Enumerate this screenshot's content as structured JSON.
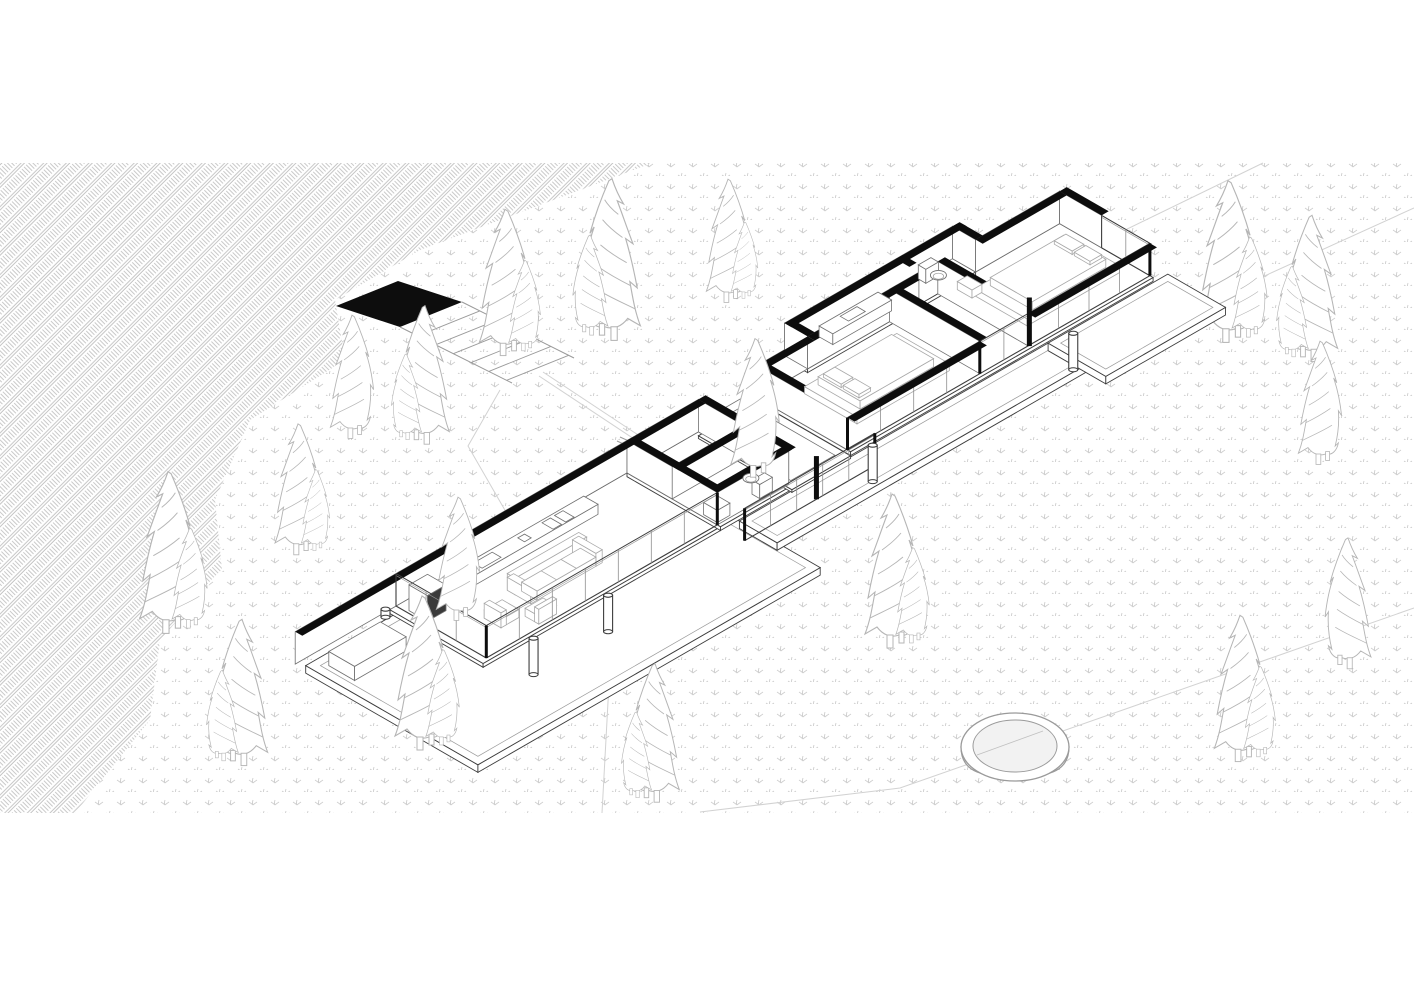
{
  "colors": {
    "paper": "#ffffff",
    "black_wall": "#0d0d0d",
    "line_dark": "#3d3d3d",
    "line_mid": "#6f6f6f",
    "line_light": "#9a9a9a",
    "glass_mullion": "#8f8f8f",
    "tree_stroke": "#b5b5b5",
    "hatch_stroke": "#b7b7b7",
    "dots_stroke": "#cdcdcd",
    "contour": "#d2d2d2",
    "water": "#f2f2f2",
    "furniture_light": "#a8a8a8",
    "dark_face": "#3a3a3a"
  },
  "iso": {
    "ox": 396,
    "oy": 606,
    "kx": 21,
    "ky": 12.1,
    "kz": 27,
    "wallH": 1.2,
    "bandTh": 0.34
  },
  "regions": {
    "hatch_slope": [
      [
        0,
        163
      ],
      [
        652,
        163
      ],
      [
        420,
        250
      ],
      [
        335,
        300
      ],
      [
        345,
        360
      ],
      [
        250,
        420
      ],
      [
        215,
        500
      ],
      [
        222,
        570
      ],
      [
        160,
        640
      ],
      [
        150,
        720
      ],
      [
        75,
        813
      ],
      [
        0,
        813
      ]
    ],
    "dotted_meadow": [
      [
        652,
        163
      ],
      [
        1414,
        163
      ],
      [
        1414,
        813
      ],
      [
        75,
        813
      ],
      [
        150,
        720
      ],
      [
        160,
        640
      ],
      [
        222,
        570
      ],
      [
        215,
        500
      ],
      [
        250,
        420
      ],
      [
        345,
        360
      ],
      [
        335,
        300
      ],
      [
        420,
        250
      ]
    ]
  },
  "contours": [
    [
      [
        940,
        320
      ],
      [
        1263,
        163
      ]
    ],
    [
      [
        1150,
        328
      ],
      [
        1414,
        208
      ]
    ],
    [
      [
        700,
        812
      ],
      [
        900,
        788
      ],
      [
        1414,
        608
      ]
    ]
  ],
  "trail": [
    [
      500,
      390
    ],
    [
      468,
      446
    ],
    [
      525,
      545
    ],
    [
      610,
      665
    ],
    [
      602,
      813
    ]
  ],
  "stairs": {
    "landing": [
      [
        336,
        306
      ],
      [
        398,
        281
      ],
      [
        462,
        302
      ],
      [
        400,
        327
      ]
    ],
    "railA": [
      [
        400,
        327
      ],
      [
        512,
        383
      ]
    ],
    "railB": [
      [
        462,
        302
      ],
      [
        574,
        358
      ]
    ],
    "steps": 6,
    "path": [
      [
        543,
        372
      ],
      [
        688,
        468
      ]
    ],
    "path2": [
      [
        539,
        376
      ],
      [
        684,
        472
      ]
    ]
  },
  "bridge": {
    "l1": [
      [
        620,
        437
      ],
      [
        688,
        468
      ]
    ],
    "l2": [
      [
        617,
        441
      ],
      [
        685,
        472
      ]
    ]
  },
  "trees_back": [
    {
      "x": 505,
      "y": 348,
      "s": 0.95,
      "f": 0,
      "d": 1
    },
    {
      "x": 612,
      "y": 332,
      "s": 1.05,
      "f": 1,
      "d": 1
    },
    {
      "x": 728,
      "y": 296,
      "s": 0.8,
      "f": 0,
      "d": 1
    },
    {
      "x": 352,
      "y": 432,
      "s": 0.8,
      "f": 0,
      "d": 0
    },
    {
      "x": 425,
      "y": 437,
      "s": 0.9,
      "f": 1,
      "d": 1
    },
    {
      "x": 298,
      "y": 548,
      "s": 0.85,
      "f": 0,
      "d": 1
    },
    {
      "x": 168,
      "y": 625,
      "s": 1.05,
      "f": 0,
      "d": 1
    },
    {
      "x": 242,
      "y": 758,
      "s": 0.95,
      "f": 1,
      "d": 1
    },
    {
      "x": 1228,
      "y": 334,
      "s": 1.05,
      "f": 0,
      "d": 1
    },
    {
      "x": 1312,
      "y": 354,
      "s": 0.95,
      "f": 1,
      "d": 1
    },
    {
      "x": 1320,
      "y": 458,
      "s": 0.8,
      "f": 0,
      "d": 0
    }
  ],
  "trees_front": [
    {
      "x": 755,
      "y": 470,
      "s": 0.9,
      "f": 0,
      "d": 0
    },
    {
      "x": 458,
      "y": 614,
      "s": 0.8,
      "f": 0,
      "d": 0
    },
    {
      "x": 422,
      "y": 742,
      "s": 1.0,
      "f": 0,
      "d": 1
    },
    {
      "x": 655,
      "y": 795,
      "s": 0.9,
      "f": 1,
      "d": 1
    },
    {
      "x": 892,
      "y": 640,
      "s": 1.0,
      "f": 0,
      "d": 1
    },
    {
      "x": 1240,
      "y": 754,
      "s": 0.95,
      "f": 0,
      "d": 1
    },
    {
      "x": 1348,
      "y": 662,
      "s": 0.85,
      "f": 1,
      "d": 0
    }
  ],
  "hot_tub": {
    "x": 1015,
    "y": 747,
    "rx": 54,
    "ry": 34,
    "irx": 42,
    "iry": 26,
    "depth": 30
  },
  "slabs": [
    {
      "n": "terrace-deck",
      "a1": -4.5,
      "b1": 0.2,
      "a2": 11.8,
      "b2": 8.4,
      "z": -0.1,
      "th": 0.28,
      "inset": 0.35
    },
    {
      "n": "walkway-deck",
      "a1": 11.8,
      "b1": 4.55,
      "a2": 26.5,
      "b2": 6.35,
      "z": -0.1,
      "th": 0.28,
      "inset": 0.3
    },
    {
      "n": "right-deck",
      "a1": 26.5,
      "b1": 4.55,
      "a2": 32.2,
      "b2": 7.3,
      "z": -0.1,
      "th": 0.28,
      "inset": 0.3
    },
    {
      "n": "living-floor",
      "a1": -0.3,
      "b1": 0,
      "a2": 11,
      "b2": 4.45,
      "z": 0,
      "th": 0.14,
      "inset": 0
    },
    {
      "n": "middle-floor",
      "a1": 11,
      "b1": 0,
      "a2": 14.4,
      "b2": 4.45,
      "z": 0,
      "th": 0.14,
      "inset": 0
    },
    {
      "n": "courtyard-floor",
      "a1": 14.4,
      "b1": 0,
      "a2": 17.2,
      "b2": 4.45,
      "z": -0.15,
      "th": 0.1,
      "inset": 0
    },
    {
      "n": "right-wing-floor",
      "a1": 17.2,
      "b1": 0,
      "a2": 31.6,
      "b2": 4.45,
      "z": 0,
      "th": 0.14,
      "inset": 0
    },
    {
      "n": "bath-strip-floor",
      "a1": 19.6,
      "b1": -1.15,
      "a2": 27.6,
      "b2": 0,
      "z": 0,
      "th": 0.14,
      "inset": 0
    }
  ],
  "court_paving": {
    "a1": 14.75,
    "b1": 0.4,
    "a2": 16.85,
    "b2": 4.05,
    "z": -0.15
  },
  "wall_faces": [
    {
      "n": "site-wall",
      "dir": "a",
      "a1": -4.8,
      "a2": 11,
      "b": 0,
      "h": 1.2
    },
    {
      "n": "court-parapet",
      "dir": "a",
      "a1": 14.4,
      "a2": 17.2,
      "b": 0,
      "h": 0.32
    },
    {
      "n": "mid-back-wall",
      "dir": "a",
      "a1": 11,
      "a2": 14.4,
      "b": 0,
      "h": 1.2
    },
    {
      "n": "mid-divider-left",
      "dir": "b",
      "b1": 0,
      "b2": 4.3,
      "a": 11,
      "h": 1.2
    },
    {
      "n": "mid-cross-wall",
      "dir": "a",
      "a1": 11,
      "a2": 14.4,
      "b": 2.15,
      "h": 1.2
    },
    {
      "n": "mid-divider-right",
      "dir": "b",
      "b1": 0,
      "b2": 4.3,
      "a": 14.4,
      "h": 1.2
    },
    {
      "n": "mid-front-wall",
      "dir": "a",
      "a1": 11,
      "a2": 14.4,
      "b": 4.3,
      "h": 1.2
    },
    {
      "n": "rw-back-1",
      "dir": "a",
      "a1": 17.05,
      "a2": 19.6,
      "b": 0,
      "h": 1.2
    },
    {
      "n": "rw-bath-jog-l",
      "dir": "b",
      "b1": -1.1,
      "b2": 0,
      "a": 19.6,
      "h": 1.2
    },
    {
      "n": "rw-bath-back",
      "dir": "a",
      "a1": 19.6,
      "a2": 27.6,
      "b": -1.1,
      "h": 1.2
    },
    {
      "n": "rw-bath-jog-r",
      "dir": "b",
      "b1": -1.1,
      "b2": 0,
      "a": 27.6,
      "h": 1.2
    },
    {
      "n": "rw-back-2",
      "dir": "a",
      "a1": 27.6,
      "a2": 31.6,
      "b": 0,
      "h": 1.2
    },
    {
      "n": "rw-bath-front",
      "dir": "a",
      "a1": 19.6,
      "a2": 24.9,
      "b": 0,
      "h": 1.2
    },
    {
      "n": "rw-divider-1",
      "dir": "b",
      "b1": 0,
      "b2": 4.3,
      "a": 17.2,
      "h": 1.2
    },
    {
      "n": "rw-divider-2",
      "dir": "b",
      "b1": 0,
      "b2": 4.3,
      "a": 23.5,
      "h": 1.2
    },
    {
      "n": "rw-divider-3",
      "dir": "b",
      "b1": 0,
      "b2": 4.3,
      "a": 25.8,
      "h": 1.2
    },
    {
      "n": "rw-end-wall",
      "dir": "b",
      "b1": 0,
      "b2": 4.3,
      "a": 31.6,
      "h": 1.2
    }
  ],
  "cut_bands": [
    {
      "n": "band-living-back",
      "dir": "a",
      "a1": -4.8,
      "a2": 11.25,
      "b": 0
    },
    {
      "n": "band-mid-back",
      "dir": "a",
      "a1": 11,
      "a2": 14.4,
      "b": 0
    },
    {
      "n": "band-mid-cross",
      "dir": "a",
      "a1": 11,
      "a2": 14.4,
      "b": 2.15
    },
    {
      "n": "band-mid-front",
      "dir": "a",
      "a1": 11,
      "a2": 14.55,
      "b": 3.96
    },
    {
      "n": "band-mid-div-l",
      "dir": "b",
      "b1": 0,
      "b2": 4.3,
      "a": 11
    },
    {
      "n": "band-mid-div-r",
      "dir": "b",
      "b1": 0,
      "b2": 4.3,
      "a": 14.4
    },
    {
      "n": "band-rw-back-1",
      "dir": "a",
      "a1": 17.05,
      "a2": 19.6,
      "b": 0
    },
    {
      "n": "band-rw-bath-back",
      "dir": "a",
      "a1": 19.6,
      "a2": 27.94,
      "b": -1.1
    },
    {
      "n": "band-rw-jog-l",
      "dir": "b",
      "b1": -1.1,
      "b2": 0,
      "a": 19.6
    },
    {
      "n": "band-rw-jog-r",
      "dir": "b",
      "b1": -1.1,
      "b2": 0,
      "a": 27.6
    },
    {
      "n": "band-rw-bath-front",
      "dir": "a",
      "a1": 19.6,
      "a2": 24.9,
      "b": 0
    },
    {
      "n": "band-rw-back-2",
      "dir": "a",
      "a1": 27.6,
      "a2": 31.6,
      "b": 0
    },
    {
      "n": "band-rw-div-1",
      "dir": "b",
      "b1": 0,
      "b2": 4.3,
      "a": 17.2
    },
    {
      "n": "band-rw-div-2",
      "dir": "b",
      "b1": 0,
      "b2": 4.3,
      "a": 23.5
    },
    {
      "n": "band-rw-div-3",
      "dir": "b",
      "b1": 0,
      "b2": 4.3,
      "a": 25.8
    },
    {
      "n": "band-rw-end",
      "dir": "b",
      "b1": 0,
      "b2": 2.0,
      "a": 31.6
    },
    {
      "n": "band-vanity-nib",
      "dir": "b",
      "b1": -1.1,
      "b2": -0.45,
      "a": 24.9
    }
  ],
  "fascia_bands": [
    {
      "n": "fascia-bed1",
      "dir": "a",
      "a1": 17.2,
      "a2": 23.5,
      "b": 4.3
    },
    {
      "n": "fascia-bed2",
      "dir": "a",
      "a1": 25.8,
      "a2": 31.6,
      "b": 4.3
    }
  ],
  "glass_walls": [
    {
      "n": "glass-living-end",
      "dir": "b",
      "b1": 0,
      "b2": 4.3,
      "a": 0,
      "h": 1.2,
      "m": 3
    },
    {
      "n": "glass-living-front",
      "dir": "a",
      "a1": 0,
      "a2": 11,
      "b": 4.3,
      "h": 1.2,
      "m": 7
    },
    {
      "n": "glass-corridor-front",
      "dir": "a",
      "a1": 11,
      "a2": 17.2,
      "b": 5.6,
      "h": 1.2,
      "m": 5
    },
    {
      "n": "glass-bed1-front",
      "dir": "a",
      "a1": 17.2,
      "a2": 23.5,
      "b": 4.3,
      "h": 1.2,
      "m": 4
    },
    {
      "n": "glass-hall-front",
      "dir": "a",
      "a1": 23.5,
      "a2": 25.8,
      "b": 4.3,
      "h": 1.2,
      "m": 2
    },
    {
      "n": "glass-bed2-front",
      "dir": "a",
      "a1": 25.8,
      "a2": 31.6,
      "b": 4.3,
      "h": 1.2,
      "m": 4
    },
    {
      "n": "glass-rw-end",
      "dir": "b",
      "b1": 2.0,
      "b2": 4.3,
      "a": 31.6,
      "h": 1.2,
      "m": 2
    }
  ],
  "furniture": {
    "boxes": [
      {
        "n": "outdoor-planter-bench",
        "a1": -3.95,
        "b1": 0.75,
        "a2": -1.5,
        "b2": 1.98,
        "z": -0.1,
        "h": 0.52
      },
      {
        "n": "kitchen-counter",
        "a1": 1.0,
        "b1": 0.34,
        "a2": 8.6,
        "b2": 1.02,
        "z": 0,
        "h": 0.37
      },
      {
        "n": "fireplace-stove",
        "a1": 0.12,
        "b1": 0.5,
        "a2": 1.0,
        "b2": 1.38,
        "z": 0,
        "h": 0.95,
        "dark": 1
      },
      {
        "n": "sofa-back",
        "a1": 3.3,
        "b1": 2.0,
        "a2": 6.7,
        "b2": 2.38,
        "z": 0,
        "h": 0.62,
        "lt": 1
      },
      {
        "n": "sofa-arm-left",
        "a1": 3.3,
        "b1": 2.0,
        "a2": 3.6,
        "b2": 3.12,
        "z": 0,
        "h": 0.48,
        "lt": 1
      },
      {
        "n": "sofa-arm-right",
        "a1": 6.4,
        "b1": 2.0,
        "a2": 6.7,
        "b2": 3.12,
        "z": 0,
        "h": 0.48,
        "lt": 1
      },
      {
        "n": "sofa-seat",
        "a1": 3.6,
        "b1": 2.38,
        "a2": 6.4,
        "b2": 3.12,
        "z": 0,
        "h": 0.34,
        "lt": 1
      },
      {
        "n": "armchair-1-seat",
        "a1": 1.6,
        "b1": 2.6,
        "a2": 2.45,
        "b2": 3.4,
        "z": 0,
        "h": 0.3,
        "lt": 1
      },
      {
        "n": "armchair-1-back",
        "a1": 1.6,
        "b1": 2.6,
        "a2": 1.85,
        "b2": 3.4,
        "z": 0,
        "h": 0.55,
        "lt": 1
      },
      {
        "n": "armchair-2-seat",
        "a1": 2.65,
        "b1": 3.5,
        "a2": 3.5,
        "b2": 4.15,
        "z": 0,
        "h": 0.3,
        "lt": 1
      },
      {
        "n": "armchair-2-back",
        "a1": 2.65,
        "b1": 3.95,
        "a2": 3.5,
        "b2": 4.15,
        "z": 0,
        "h": 0.55,
        "lt": 1
      },
      {
        "n": "bath1-sink",
        "a1": 11.1,
        "b1": 3.55,
        "a2": 11.7,
        "b2": 4.2,
        "z": 0,
        "h": 0.45
      },
      {
        "n": "toilet-1-tank",
        "a1": 13.1,
        "b1": 3.85,
        "a2": 13.7,
        "b2": 4.22,
        "z": 0,
        "h": 0.52
      },
      {
        "n": "bed-1-platform",
        "a1": 18.5,
        "b1": 0.95,
        "a2": 22.9,
        "b2": 3.45,
        "z": 0,
        "h": 0.26,
        "lt": 1
      },
      {
        "n": "bed-1-mattress",
        "a1": 18.9,
        "b1": 1.2,
        "a2": 22.4,
        "b2": 3.2,
        "z": 0.26,
        "h": 0.3,
        "lt": 1
      },
      {
        "n": "bed-1-pillow-a",
        "a1": 19.0,
        "b1": 1.35,
        "a2": 19.55,
        "b2": 2.2,
        "z": 0.56,
        "h": 0.13,
        "lt": 1
      },
      {
        "n": "bed-1-pillow-b",
        "a1": 19.0,
        "b1": 2.3,
        "a2": 19.55,
        "b2": 3.05,
        "z": 0.56,
        "h": 0.13,
        "lt": 1
      },
      {
        "n": "bed-2-platform",
        "a1": 26.6,
        "b1": 0.95,
        "a2": 31.0,
        "b2": 3.45,
        "z": 0,
        "h": 0.26,
        "lt": 1
      },
      {
        "n": "bed-2-mattress",
        "a1": 27.1,
        "b1": 1.2,
        "a2": 30.6,
        "b2": 3.2,
        "z": 0.26,
        "h": 0.3,
        "lt": 1
      },
      {
        "n": "bed-2-pillow-a",
        "a1": 30.0,
        "b1": 1.35,
        "a2": 30.55,
        "b2": 2.2,
        "z": 0.56,
        "h": 0.13,
        "lt": 1
      },
      {
        "n": "bed-2-pillow-b",
        "a1": 30.0,
        "b1": 2.3,
        "a2": 30.55,
        "b2": 3.05,
        "z": 0.56,
        "h": 0.13,
        "lt": 1
      },
      {
        "n": "bed-2-wall-unit",
        "a1": 25.88,
        "b1": 0.85,
        "a2": 26.35,
        "b2": 1.55,
        "z": 0.5,
        "h": 0.3,
        "lt": 1
      },
      {
        "n": "toilet-2-tank",
        "a1": 25.95,
        "b1": -1.08,
        "a2": 26.55,
        "b2": -0.72,
        "z": 0,
        "h": 0.52
      },
      {
        "n": "bath2-vanity",
        "a1": 21.2,
        "b1": -1.05,
        "a2": 24.0,
        "b2": -0.4,
        "z": 0,
        "h": 0.4
      }
    ],
    "top_rects": [
      {
        "n": "kitchen-sink",
        "a1": 3.2,
        "b1": 0.48,
        "a2": 4.1,
        "b2": 0.9,
        "z": 0.37
      },
      {
        "n": "cooktop-pair-1",
        "a1": 6.5,
        "b1": 0.45,
        "a2": 6.9,
        "b2": 0.98,
        "z": 0.37
      },
      {
        "n": "cooktop-pair-2",
        "a1": 7.1,
        "b1": 0.45,
        "a2": 7.5,
        "b2": 0.98,
        "z": 0.37
      },
      {
        "n": "counter-tray",
        "a1": 5.3,
        "b1": 0.5,
        "a2": 5.62,
        "b2": 0.82,
        "z": 0.37
      },
      {
        "n": "vanity-basin",
        "a1": 22.1,
        "b1": -0.95,
        "a2": 22.9,
        "b2": -0.55,
        "z": 0.4
      }
    ],
    "seat_lines": [
      {
        "a": 4.53,
        "b1": 2.38,
        "b2": 3.12,
        "z": 0.34
      },
      {
        "a": 5.47,
        "b1": 2.38,
        "b2": 3.12,
        "z": 0.34
      }
    ],
    "toilet_bowls": [
      {
        "n": "toilet-1-bowl",
        "a": 13.4,
        "b": 3.5,
        "z": 0.3
      },
      {
        "n": "toilet-2-bowl",
        "a": 26.25,
        "b": -0.42,
        "z": 0.3
      }
    ],
    "outdoor_cylinder": {
      "a": -1.05,
      "b": 0.55,
      "z": 0.3,
      "r": 4.5,
      "h": 0.3
    }
  },
  "posts": {
    "thin_black": [
      [
        0,
        4.3
      ],
      [
        11,
        4.3
      ],
      [
        11,
        5.6
      ],
      [
        17.2,
        4.3
      ],
      [
        17.2,
        5.6
      ],
      [
        23.5,
        4.3
      ],
      [
        31.6,
        4.3
      ]
    ],
    "tall_black": [
      [
        25.82,
        4.34,
        1.8
      ],
      [
        14.42,
        5.6,
        1.6
      ]
    ],
    "white_columns": [
      [
        0.55,
        6.0
      ],
      [
        4.1,
        6.0
      ],
      [
        16.6,
        6.1
      ],
      [
        26.0,
        6.25
      ]
    ]
  }
}
